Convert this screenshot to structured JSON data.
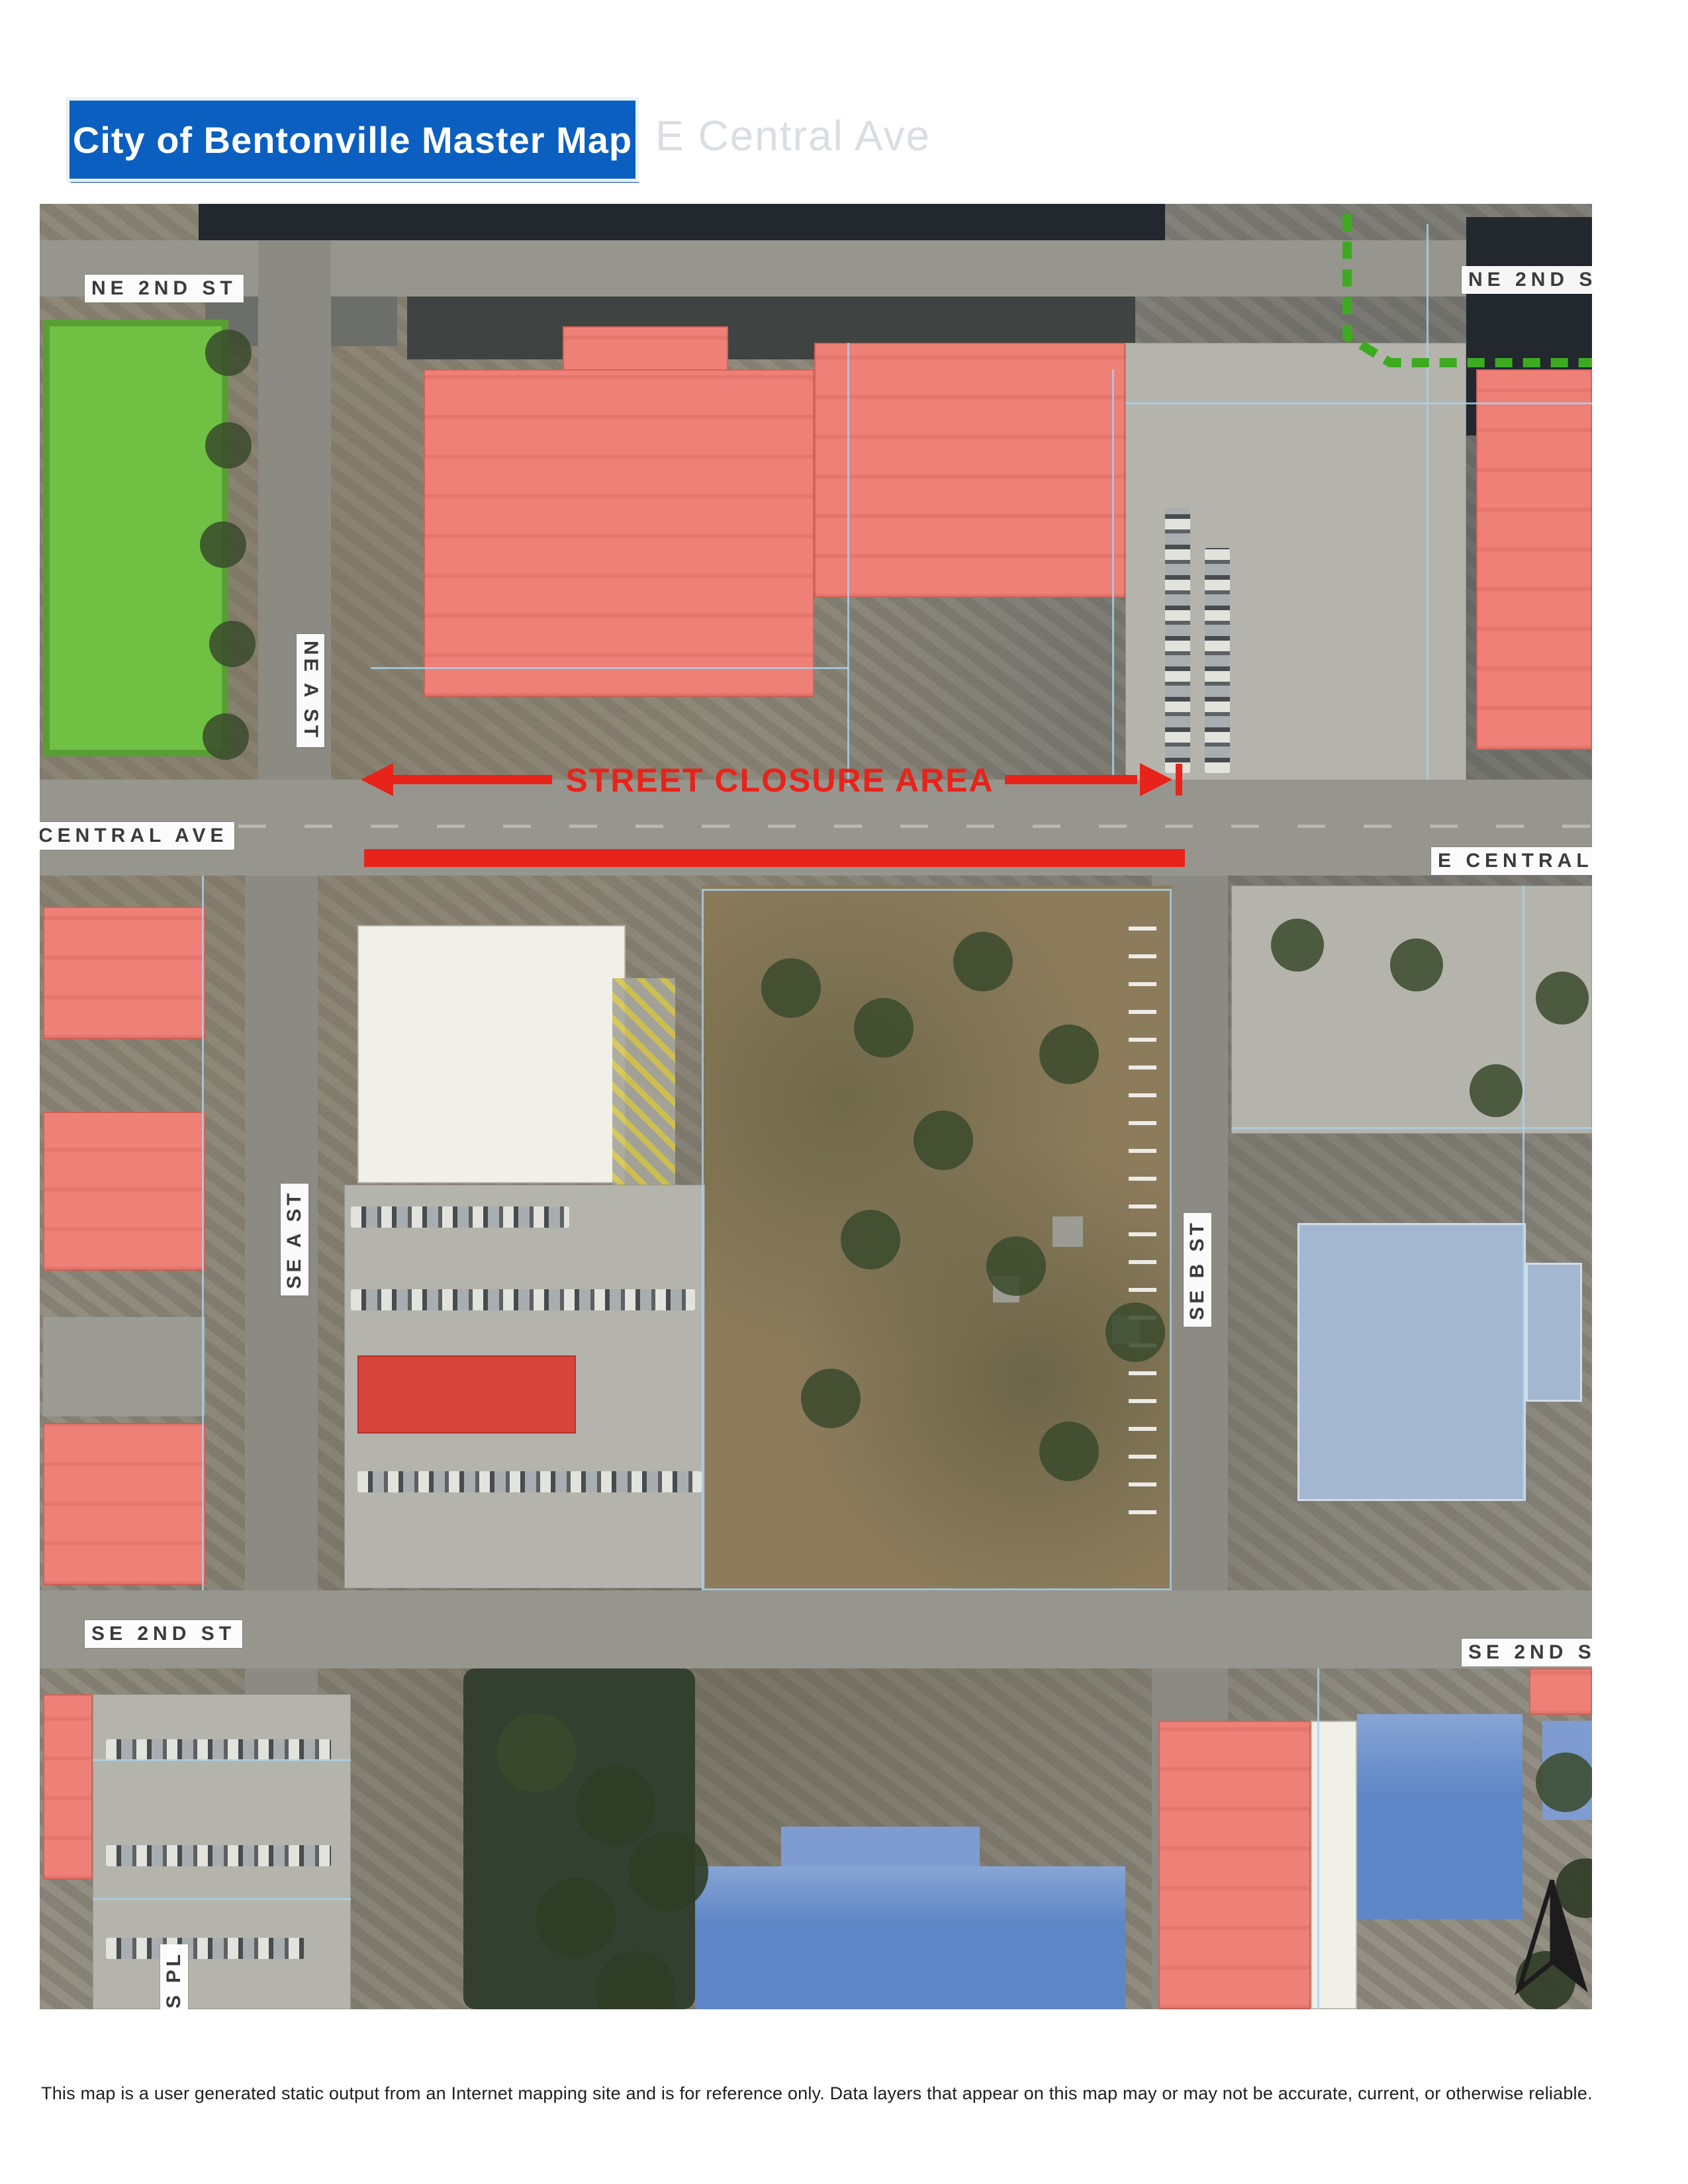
{
  "header": {
    "title": "City of Bentonville Master Map",
    "ghost_text": "E Central Ave"
  },
  "map": {
    "street_labels": [
      {
        "text": "NE 2ND ST",
        "position": "top-left"
      },
      {
        "text": "NE 2ND ST",
        "position": "top-right"
      },
      {
        "text": "NE A ST",
        "position": "upper-left-vertical"
      },
      {
        "text": "CENTRAL AVE",
        "position": "mid-left"
      },
      {
        "text": "E CENTRAL A",
        "position": "mid-right"
      },
      {
        "text": "SE A ST",
        "position": "lower-left-vertical"
      },
      {
        "text": "SE B ST",
        "position": "lower-right-vertical"
      },
      {
        "text": "SE 2ND ST",
        "position": "bottom-left"
      },
      {
        "text": "SE 2ND ST",
        "position": "bottom-right"
      },
      {
        "text": "ORES PL",
        "position": "bottom-edge-vertical"
      }
    ],
    "closure": {
      "label": "STREET CLOSURE AREA",
      "color": "#e8231a"
    },
    "colors": {
      "title_blue": "#0b5fc0",
      "closure_red": "#e8231a",
      "building_red": "#ee8077",
      "building_bright_red": "#d8453a",
      "park_green": "#6fc043",
      "roof_blue": "#5f86c6",
      "house_blue": "#a3b8d0",
      "parcel_line_blue": "#a9d2ee",
      "trail_green": "#3dab20",
      "road_gray": "#96968e"
    }
  },
  "footer": {
    "disclaimer": "This map is a user generated static output from an Internet mapping site and is for reference only. Data layers that appear on this map may or may not be accurate, current, or otherwise reliable."
  }
}
